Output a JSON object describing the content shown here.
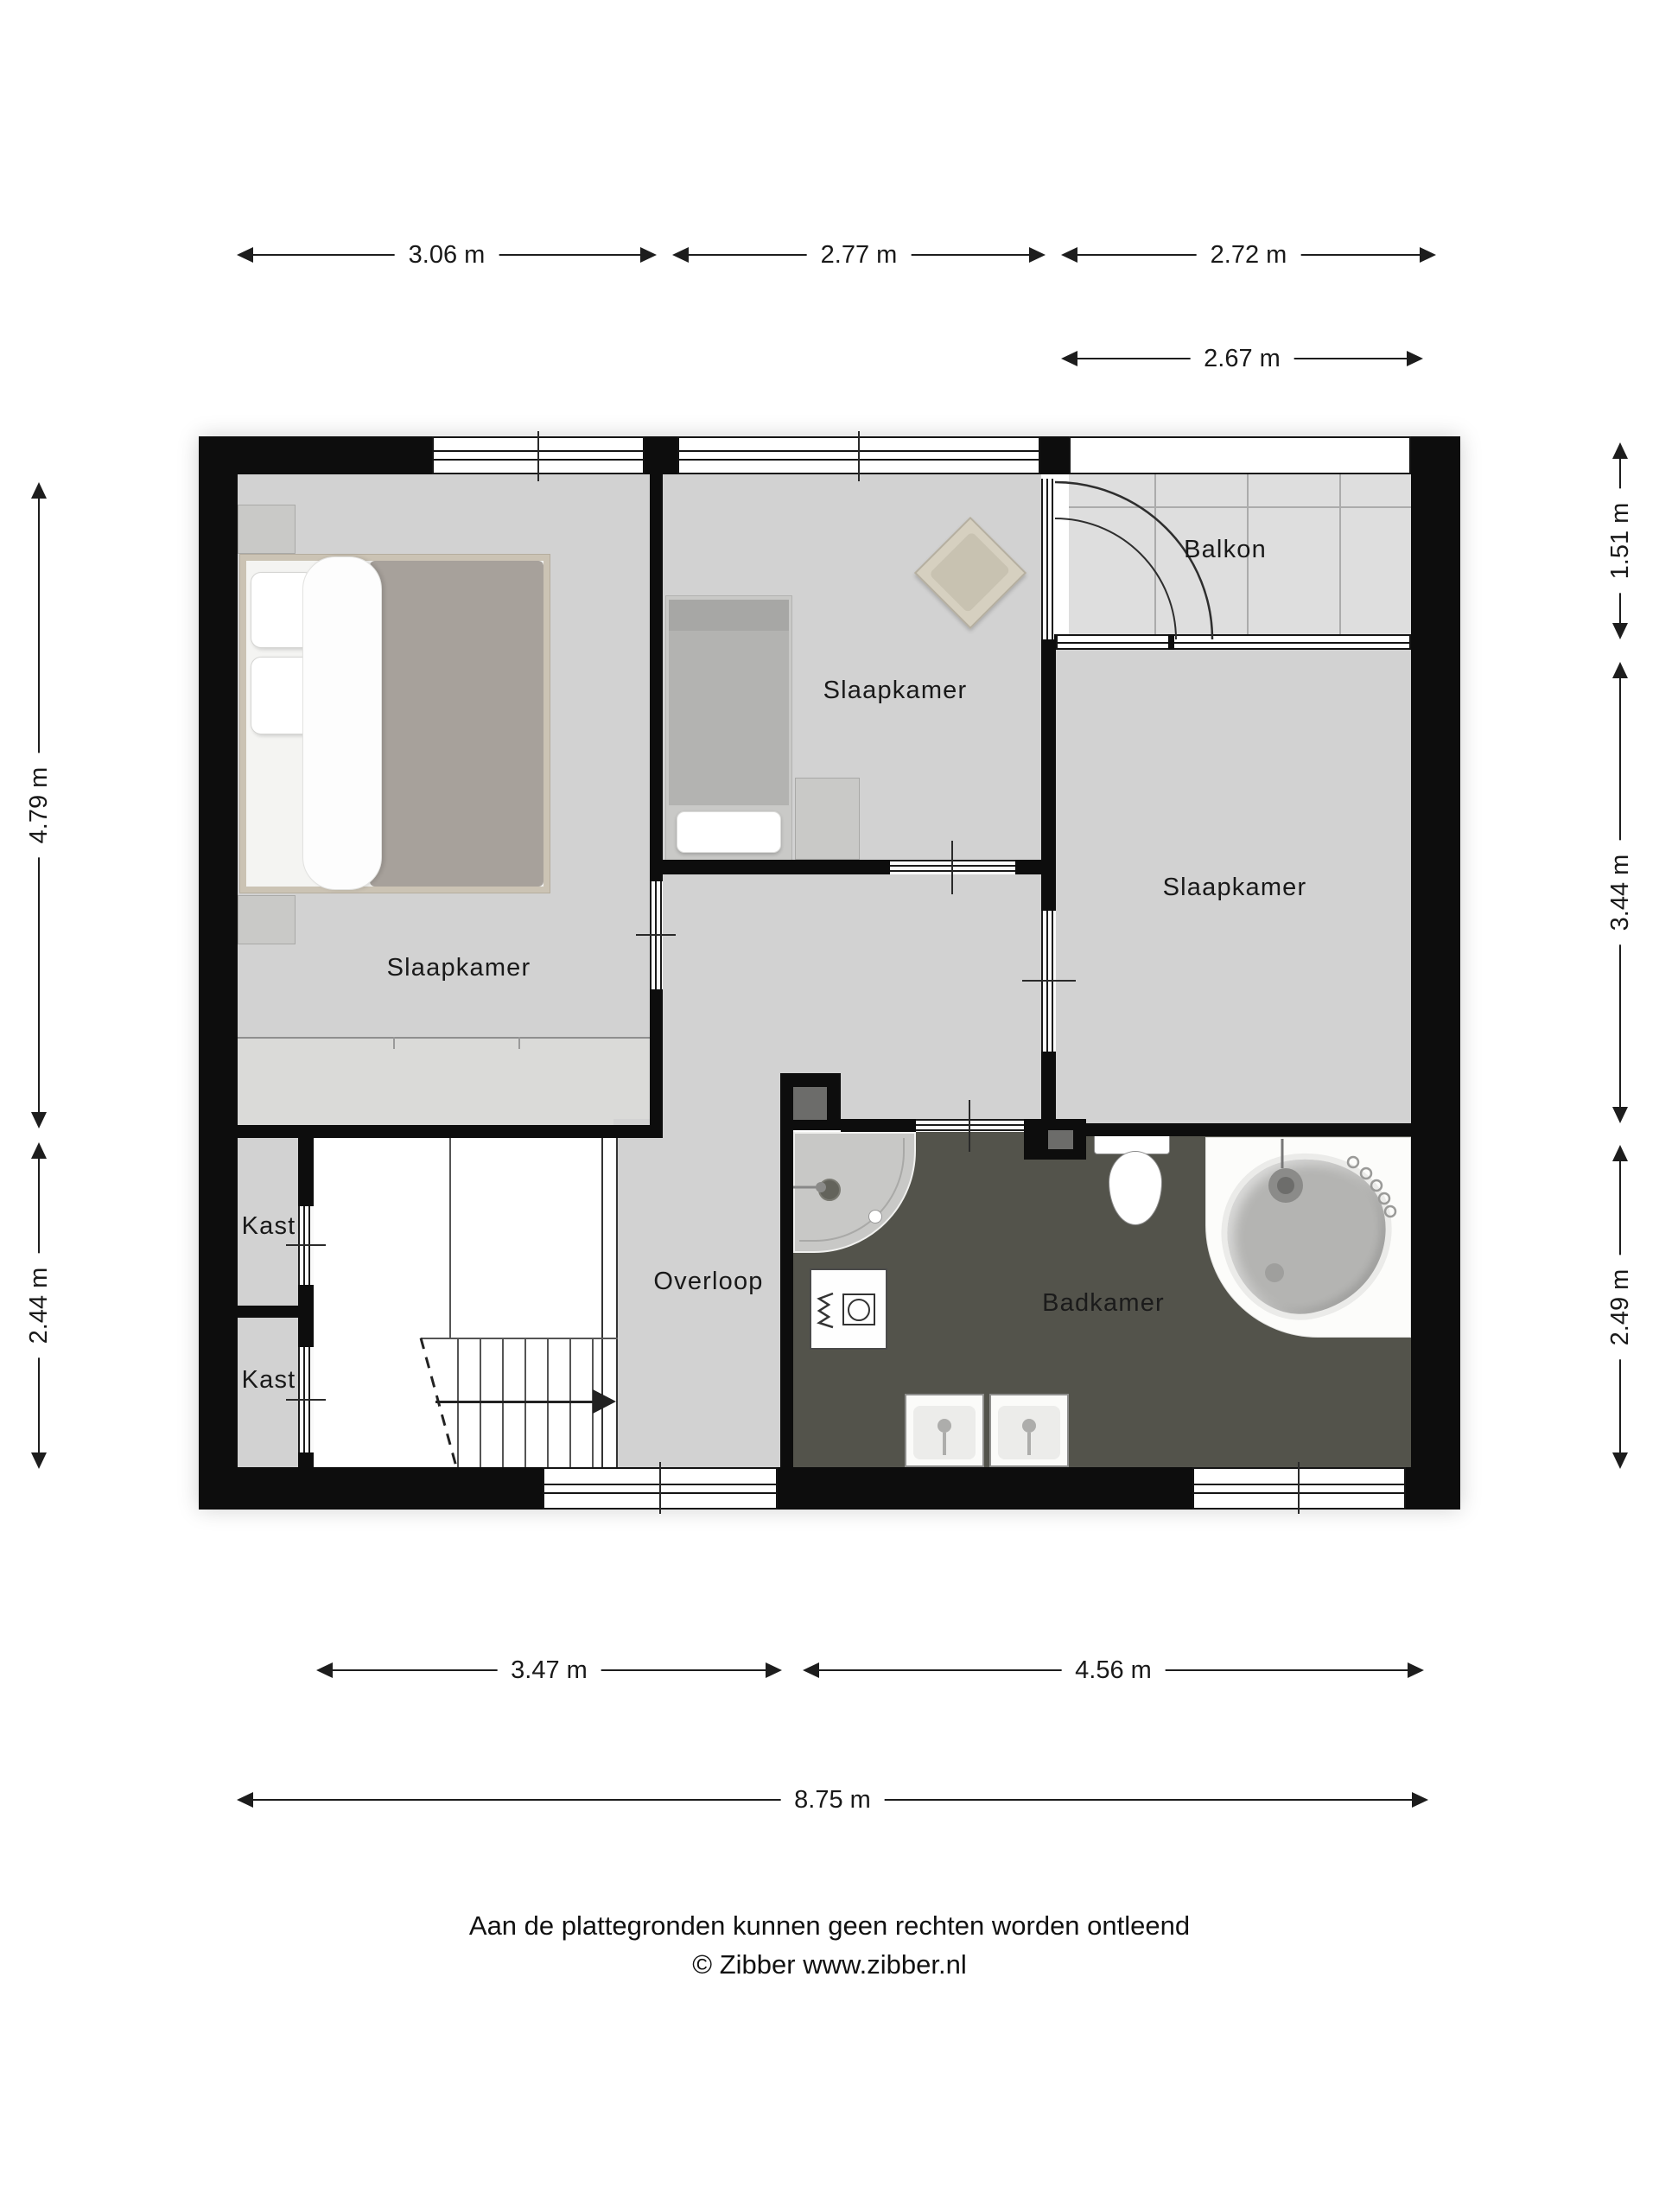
{
  "rooms": {
    "bedroom_left": {
      "label": "Slaapkamer"
    },
    "bedroom_middle": {
      "label": "Slaapkamer"
    },
    "bedroom_right": {
      "label": "Slaapkamer"
    },
    "balcony": {
      "label": "Balkon"
    },
    "landing": {
      "label": "Overloop"
    },
    "bathroom": {
      "label": "Badkamer"
    },
    "closet_upper": {
      "label": "Kast"
    },
    "closet_lower": {
      "label": "Kast"
    }
  },
  "dims": {
    "top": [
      {
        "label": "3.06 m"
      },
      {
        "label": "2.77 m"
      },
      {
        "label": "2.72 m"
      }
    ],
    "top2": [
      {
        "label": "2.67 m"
      }
    ],
    "bottom": [
      {
        "label": "3.47 m"
      },
      {
        "label": "4.56 m"
      }
    ],
    "total": [
      {
        "label": "8.75 m"
      }
    ],
    "left": [
      {
        "label": "4.79 m"
      },
      {
        "label": "2.44 m"
      }
    ],
    "right": [
      {
        "label": "1.51 m"
      },
      {
        "label": "3.44 m"
      },
      {
        "label": "2.49 m"
      }
    ]
  },
  "footer": {
    "disclaimer": "Aan de plattegronden kunnen geen rechten worden ontleend",
    "copyright": "© Zibber www.zibber.nl"
  },
  "colors": {
    "wall": "#0d0d0d",
    "floor": "#d2d2d2",
    "balcony_floor": "#dedede",
    "bathroom_floor": "#53534b",
    "stair_area": "#ffffff",
    "text": "#191919"
  }
}
